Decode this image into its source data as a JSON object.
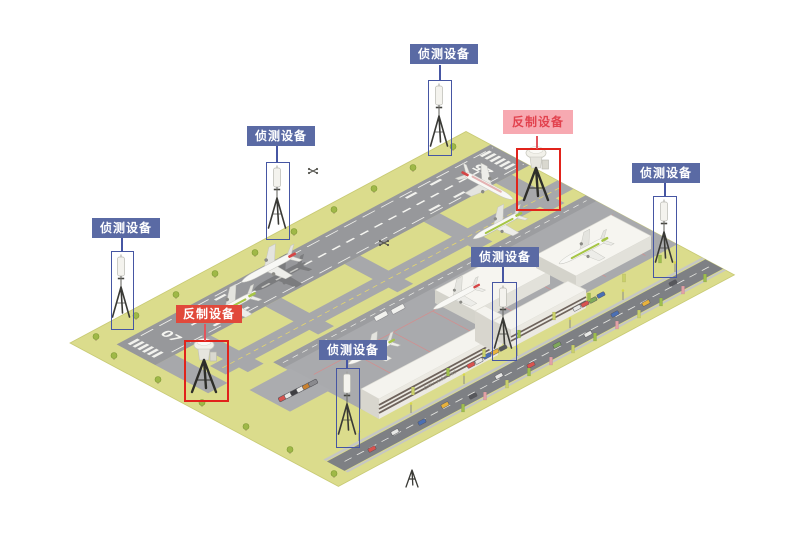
{
  "annotations": [
    {
      "id": "detection-top",
      "text": "侦测设备",
      "kind": "detection"
    },
    {
      "id": "detection-upper-left",
      "text": "侦测设备",
      "kind": "detection"
    },
    {
      "id": "detection-left",
      "text": "侦测设备",
      "kind": "detection"
    },
    {
      "id": "counter-upper-right",
      "text": "反制设备",
      "kind": "counter"
    },
    {
      "id": "detection-right",
      "text": "侦测设备",
      "kind": "detection"
    },
    {
      "id": "detection-center",
      "text": "侦测设备",
      "kind": "detection"
    },
    {
      "id": "counter-lower-left",
      "text": "反制设备",
      "kind": "counter"
    },
    {
      "id": "detection-bottom",
      "text": "侦测设备",
      "kind": "detection"
    }
  ],
  "airport": {
    "runway_threshold_left": "07",
    "runway_threshold_right": "25",
    "terminal_sign": "CITY AIRPORT"
  },
  "icons": {
    "detection_device": "antenna-tripod-icon",
    "counter_device": "radar-dish-tripod-icon",
    "spare_device": "small-tripod-icon",
    "drone": "drone-icon"
  },
  "colors": {
    "detection_label_bg": "#5A6AA4",
    "detection_label_text": "#FFFFFF",
    "detection_box_border": "#4656A3",
    "counter_label_pink_bg": "#F7A9B1",
    "counter_label_pink_text": "#E2424E",
    "counter_label_red_bg": "#E1493B",
    "counter_label_red_text": "#FFFFFF",
    "counter_box_border": "#E1231B",
    "ground": "#DBDC8C",
    "runway": "#97989B",
    "taxiway": "#A7A8AB",
    "apron": "#A9AAAD",
    "road": "#7E8084",
    "building": "#F4F3EE",
    "plane_green": "#A6C545",
    "plane_red": "#D64545"
  }
}
